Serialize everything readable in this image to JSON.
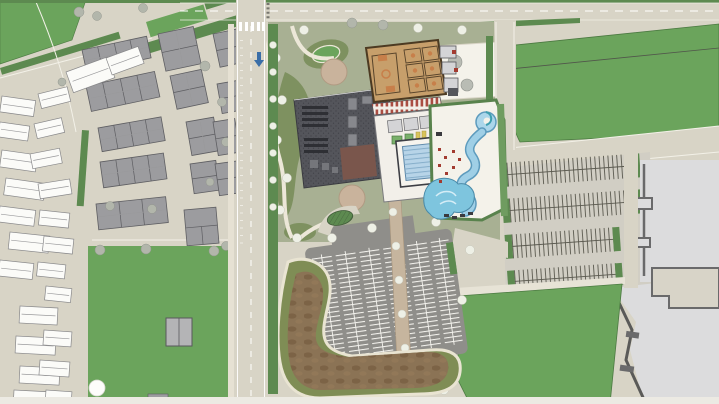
{
  "scene": {
    "kind": "aerial-site-plan-rendering",
    "subject": "community recreation center master plan with aquatics, gymnasium, parking, residential district and sports fields",
    "visible_text": "none"
  },
  "colors": {
    "road": "#d8d4c6",
    "road_light": "#e7e3d6",
    "grass_bright": "#6ba45c",
    "grass_gray": "#a8b093",
    "grass_olive": "#7e9160",
    "parkway": "#5d8a50",
    "path_cream": "#ece7d8",
    "asphalt": "#8f8e8a",
    "asphalt_light": "#d1cec4",
    "stall_white": "#f5f4ef",
    "stall_dark": "#5a594f",
    "roof_charcoal": "#54555b",
    "roof_maroon": "#7a564c",
    "roof_light": "#87888d",
    "bldg_white": "#f2efe9",
    "room_gray": "#d4d4d6",
    "court_tan": "#c79f6b",
    "court_line": "#57432a",
    "court_orange": "#c77f4a",
    "pool_light": "#b7d4e8",
    "pool_deep": "#7ec5de",
    "pool_edge": "#4a8aa8",
    "river": "#9fcfe6",
    "river_edge": "#5d9bbd",
    "deck_white": "#f4f2ea",
    "house_white": "#fbfbf8",
    "town_gray": "#9c9c9f",
    "town_dark": "#5e5e62",
    "bigbox": "#dcdcdd",
    "wall": "#6a6a6b",
    "tan_bldg": "#d8d4c8",
    "dirt": "#8b7355",
    "dirt_dark": "#74593d",
    "basin_olive": "#7f8d55",
    "tree_light": "#eef0e6",
    "tree_gray": "#b2b6ab",
    "plaza_tan": "#c9b39c",
    "walk_tan": "#c6b59e",
    "umbrella_red": "#a23b30",
    "accent_yellow": "#d8c35a",
    "arrow_blue": "#3a6ea8",
    "dark_object": "#3a3a3e",
    "bottom_strip": "#eceae3"
  },
  "features": [
    {
      "id": "residential-district",
      "fill": "road"
    },
    {
      "id": "townhouse-blocks",
      "fill": "town_gray"
    },
    {
      "id": "single-family-houses",
      "fill": "house_white"
    },
    {
      "id": "main-road-north-south",
      "fill": "road"
    },
    {
      "id": "recreation-center-roof",
      "fill": "roof_charcoal"
    },
    {
      "id": "gymnasium-courts",
      "fill": "court_tan"
    },
    {
      "id": "indoor-lap-pool",
      "fill": "pool_light"
    },
    {
      "id": "lazy-river",
      "fill": "river"
    },
    {
      "id": "leisure-pool",
      "fill": "pool_deep"
    },
    {
      "id": "outdoor-pool-deck",
      "fill": "deck_white"
    },
    {
      "id": "sports-field-east",
      "fill": "grass_bright"
    },
    {
      "id": "east-parking-lot",
      "fill": "asphalt_light"
    },
    {
      "id": "south-parking-lot",
      "fill": "asphalt"
    },
    {
      "id": "detention-basin",
      "fill": "dirt"
    },
    {
      "id": "big-box-site",
      "fill": "bigbox"
    },
    {
      "id": "south-green-field",
      "fill": "grass_bright"
    },
    {
      "id": "park-grounds",
      "fill": "grass_gray"
    }
  ]
}
